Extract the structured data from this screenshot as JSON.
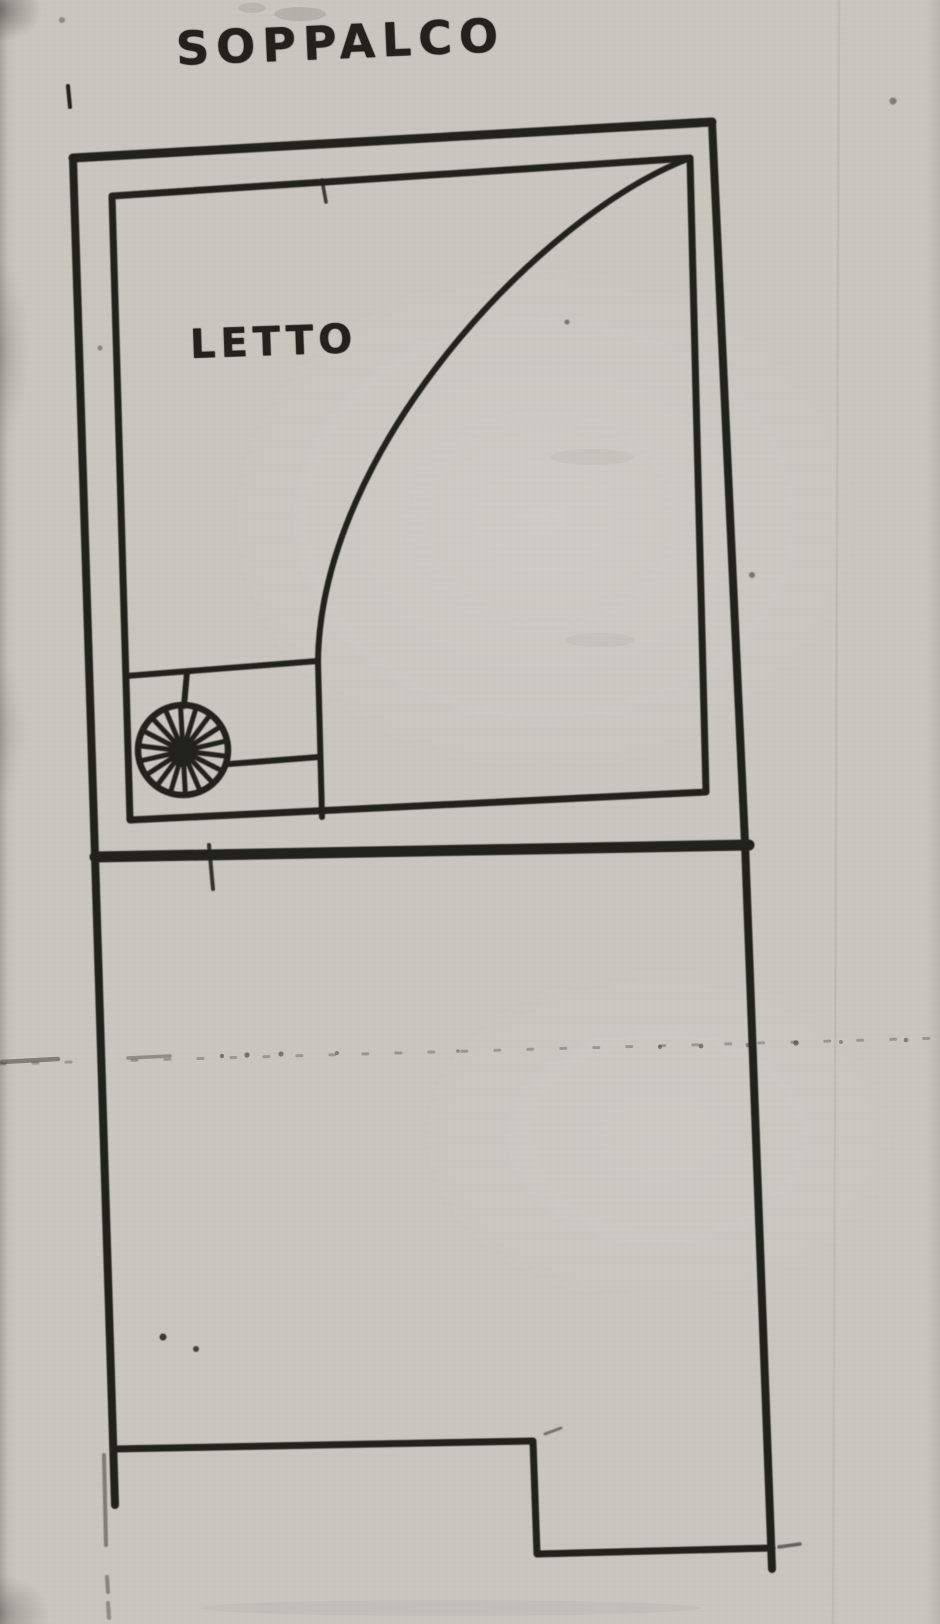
{
  "plan": {
    "mezzanine_label": "SOPPALCO",
    "bed_label": "LETTO",
    "colors": {
      "paper": "#c9c6c0",
      "ink": "#24211d",
      "crease": "#3a3732"
    }
  }
}
